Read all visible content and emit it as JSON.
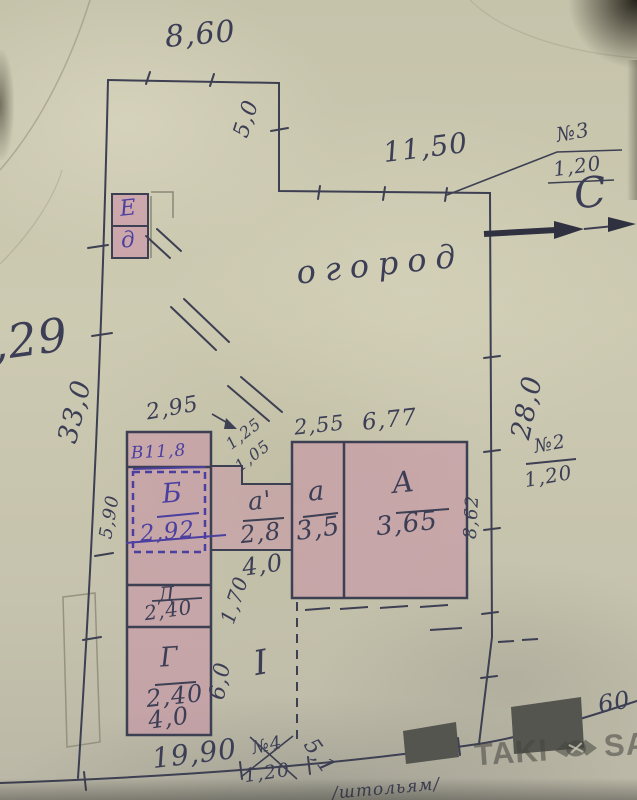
{
  "colors": {
    "ink": "#3c3e55",
    "blue_ink": "#4b3fa0",
    "building_pink": "#c98fa6",
    "paper": "#c9c6ae"
  },
  "plan": {
    "garden": "огород",
    "north": "С",
    "roman_one": "I",
    "partial_left": ",29",
    "partial_right": "60",
    "bottom_note": "/штольям/",
    "diag_dim": "5,1"
  },
  "dimensions": {
    "top": "8,60",
    "top_step": "5,0",
    "upper": "11,50",
    "left": "33,0",
    "left_inner": "5,90",
    "right": "28,0",
    "house_right": "8,62",
    "strip_top": "2,95",
    "step_upper": "1,25",
    "step_lower": "1,05",
    "house_top_left": "2,55",
    "house_top_right": "6,77",
    "annex_bottom": "4,0",
    "garage_bottom": "4,0",
    "yard_height": "6,0",
    "yard_upper": "1,70",
    "bottom": "19,90"
  },
  "gates": [
    {
      "no": "№3",
      "width": "1,20"
    },
    {
      "no": "№2",
      "width": "1,20"
    },
    {
      "no": "№4",
      "width": "1,20"
    }
  ],
  "buildings": {
    "v_label": "В11,8",
    "rooms": [
      {
        "name": "Б",
        "value": "2,92"
      },
      {
        "name": "Д",
        "value": "2,40"
      },
      {
        "name": "Г",
        "value": "2,40"
      },
      {
        "name": "а'",
        "value": "2,8"
      },
      {
        "name": "а",
        "value": "3,5"
      },
      {
        "name": "А",
        "value": "3,65"
      }
    ],
    "shed_top": "Е",
    "shed_bottom": "д"
  },
  "watermark": {
    "left": "TAKI",
    "right": "SALE"
  }
}
